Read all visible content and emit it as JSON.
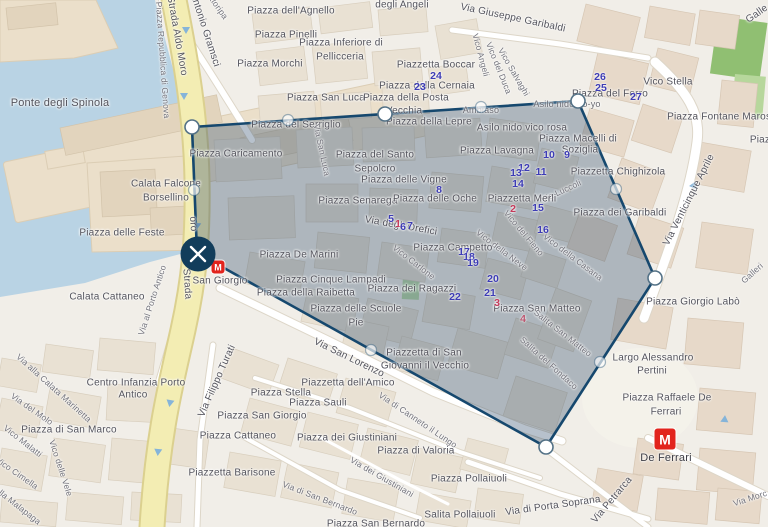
{
  "map": {
    "city_area": "Genova centro storico",
    "labels": {
      "ponte_degli_spinola": "Ponte degli Spinola",
      "strada_aldo_moro": "Strada Aldo Moro",
      "piazza_repubblica": "Piazza Repubblica di Genova",
      "antonio_gramsci": "Antonio Gramsci",
      "sottoripa": "ttoripa",
      "piazza_dell_agnello": "Piazza dell'Agnello",
      "degli_angeli": "degli Angeli",
      "via_garibaldi": "Via Giuseppe Garibaldi",
      "piazza_pinelli": "Piazza Pinelli",
      "piazza_inferiore_1": "Piazza Inferiore di",
      "piazza_inferiore_2": "Pellicceria",
      "piazza_morchi": "Piazza Morchi",
      "piazzetta_boccar": "Piazzetta Boccar",
      "piazza_cernaia": "Piazza della Cernaia",
      "vico_angeli": "Vico Angeli",
      "vico_del_duca": "Vico del Duca",
      "vico_salvaghi": "Vico Salvaghi",
      "piazza_san_luca": "Piazza San Luca",
      "piazza_posta_1": "Piazza della Posta",
      "piazza_posta_2": "Vecchia",
      "piazza_lepre": "Piazza della Lepre",
      "piazza_serriglio": "Piazza del Serriglio",
      "vico_stella": "Vico Stella",
      "piazza_del_ferro": "Piazza del Ferro",
      "piazza_fontane_marose": "Piazza Fontane Marose",
      "galle": "Galle",
      "piaz": "Piaz",
      "asilo_yoyo": "Asilo nido Yo-yo",
      "asilo_vico_rosa": "Asilo nido vico rosa",
      "ambiaso": "Ambiaso",
      "piazza_macelli_1": "Piazza Macelli di",
      "piazza_macelli_2": "Soziglia",
      "piazza_lavagna": "Piazza Lavagna",
      "piazza_caricamento": "Piazza Caricamento",
      "calata_falcone_1": "Calata Falcone",
      "calata_falcone_2": "Borsellino",
      "sepolcro_1": "Piazza del Santo",
      "sepolcro_2": "Sepolcro",
      "via_san_luca": "Via San Luca",
      "piazza_vigne": "Piazza delle Vigne",
      "piazzetta_chighizola": "Piazzetta Chighizola",
      "via_luccoli": "Via Luccoli",
      "piazza_senarega": "Piazza Senarega",
      "piazza_oche": "Piazza delle Oche",
      "piazzetta_merli": "Piazzetta Merli",
      "piazza_garibaldi": "Piazza dei Garibaldi",
      "via_xxv_aprile": "Via Venticinque Aprile",
      "piazza_feste": "Piazza delle Feste",
      "via_orefici": "Via degli Orefici",
      "vico_fieno": "Vico del Fieno",
      "vico_neve": "Vico della Neve",
      "vico_casana": "Vico della Casana",
      "piazza_de_marini": "Piazza De Marini",
      "piazza_campetto": "Piazza Campetto",
      "vico_carlone": "Vico Carlone",
      "oro_mid": "oro",
      "strada_mid": "Strada",
      "piazza_cinque_lampadi": "Piazza Cinque Lampadi",
      "san_giorgio": "San Giorgio",
      "piazza_raibetta": "Piazza della Raibetta",
      "calata_cattaneo": "Calata Cattaneo",
      "via_porto_antico": "Via al Porto Antico",
      "piazza_san_matteo": "Piazza San Matteo",
      "salita_san_matteo": "Salita San Matteo",
      "salita_fondaco": "Salita del Fondaco",
      "scuole_1": "Piazza delle Scuole",
      "scuole_2": "Pie",
      "piazza_ragazzi": "Piazza dei Ragazzi",
      "largo_pertini_1": "Largo Alessandro",
      "largo_pertini_2": "Pertini",
      "piazza_labo": "Piazza Giorgio Labò",
      "giovanni_1": "Piazzetta di San",
      "giovanni_2": "Giovanni il Vecchio",
      "via_san_lorenzo": "Via San Lorenzo",
      "piazzetta_amico": "Piazzetta dell'Amico",
      "piazza_stella": "Piazza Stella",
      "piazza_sauli": "Piazza Sauli",
      "piazza_san_giorgio": "Piazza San Giorgio",
      "piazza_cattaneo": "Piazza Cattaneo",
      "piazzetta_barisone": "Piazzetta Barisone",
      "via_turati": "Via Filippo Turati",
      "centro_infanzia_1": "Centro Infanzia Porto",
      "centro_infanzia_2": "Antico",
      "via_marinetta": "Via alla Calata Marinetta",
      "via_del_molo": "Via del Molo",
      "vico_malatti": "Vico Malatti",
      "vico_cimella": "Vico Cimella",
      "della_malapaga": "della Malapaga",
      "piazza_san_marco": "Piazza di San Marco",
      "vico_vele": "Vico delle Vele",
      "via_canneto": "Via di Canneto il Lungo",
      "piazza_valoria": "Piazza di Valoria",
      "piazza_giustiniani": "Piazza dei Giustiniani",
      "via_giustiniani": "Via dei Giustiniani",
      "via_san_bernardo": "Via di San Bernardo",
      "piazza_san_bernardo": "Piazza San Bernardo",
      "piazza_pollaiuoli": "Piazza Pollaiuoli",
      "salita_pollaiuoli": "Salita Pollaiuoli",
      "via_porta_soprana": "Via di Porta Soprana",
      "via_petrarca": "Via Petrarca",
      "ferrari_1": "Piazza Raffaele De",
      "ferrari_2": "Ferrari",
      "de_ferrari_station": "De Ferrari",
      "via_morc": "Via Morc",
      "galleri": "Galleri"
    }
  },
  "metro": {
    "m": "M",
    "stations": [
      "San Giorgio",
      "De Ferrari"
    ]
  },
  "markers": {
    "red": [
      "1",
      "2",
      "3",
      "4"
    ],
    "blue": [
      "5",
      "6",
      "7",
      "8",
      "9",
      "10",
      "11",
      "12",
      "13",
      "14",
      "15",
      "16",
      "17",
      "18",
      "19",
      "20",
      "21",
      "22",
      "23",
      "24",
      "25",
      "26",
      "27"
    ]
  },
  "overlay": {
    "points": "192,127 385,114 578,101 655,278 546,447 197,253",
    "vertex_count": 6
  },
  "colors": {
    "water": "#b9d3e4",
    "land": "#f1eee8",
    "road_yellow": "#f3edb3",
    "polygon_fill": "rgba(49,77,109,0.35)",
    "polygon_stroke": "#16486e",
    "marker_blue": "#3d3cb5",
    "marker_red": "#c43a5a",
    "metro_red": "#e2241d",
    "close_button": "#123d5b"
  }
}
